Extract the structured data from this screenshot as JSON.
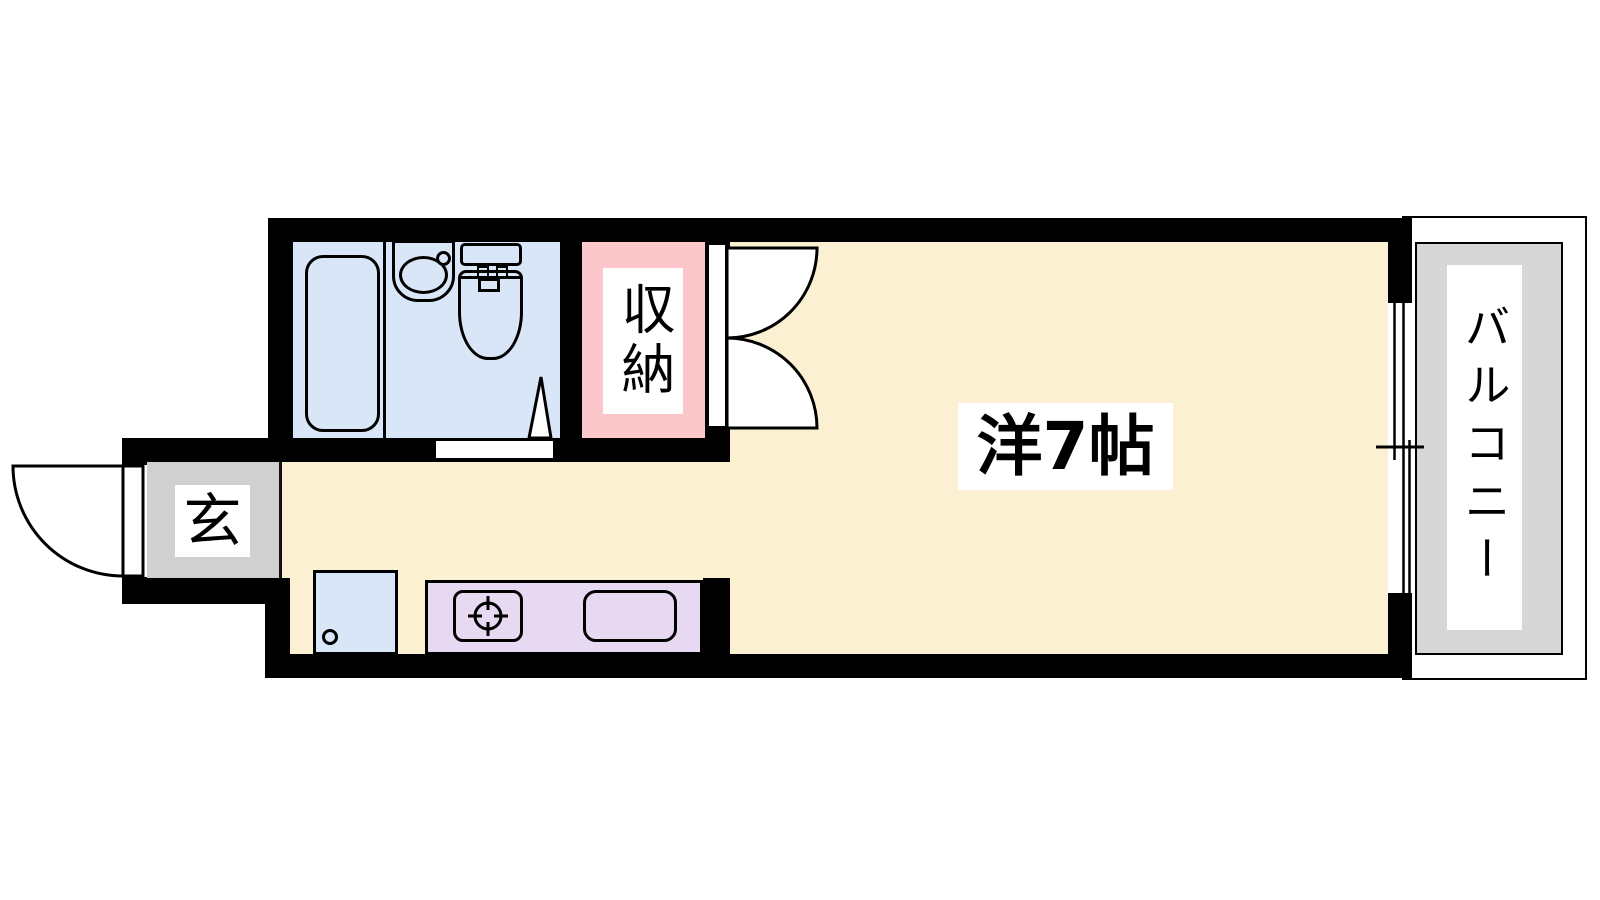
{
  "floorplan": {
    "labels": {
      "main_room": "洋7帖",
      "closet": "収納",
      "entrance": "玄",
      "balcony": "バルコニー"
    },
    "colors": {
      "wall_black": "#000000",
      "room_cream": "#FCF0D2",
      "bathroom_blue": "#D9E6F8",
      "closet_pink": "#FCC7CB",
      "kitchen_lavender": "#E7D9F1",
      "entrance_gray": "#D0D0D0",
      "balcony_gray": "#D7D7D7",
      "label_background": "#FFFFFF",
      "line_black": "#000000"
    },
    "fixtures": [
      "bathtub",
      "vanity-sink",
      "faucet",
      "toilet",
      "bathroom-door-swing",
      "closet-double-doors",
      "entrance-door-swing",
      "washing-machine-pan",
      "drain",
      "kitchen-counter",
      "stove-burner",
      "kitchen-sink",
      "sliding-window",
      "balcony-deck"
    ]
  }
}
